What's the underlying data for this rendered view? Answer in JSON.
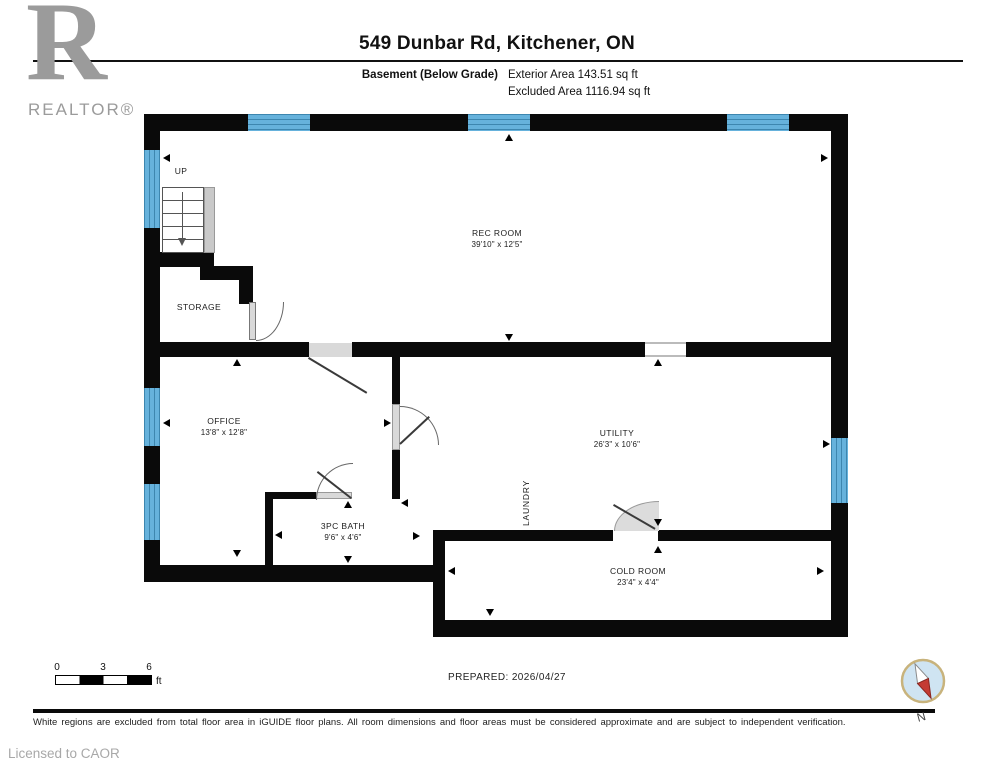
{
  "header": {
    "logo_r": "R",
    "logo_text": "REALTOR®",
    "title": "549 Dunbar Rd, Kitchener, ON",
    "floor_label": "Basement (Below Grade)",
    "area_line1": "Exterior Area 143.51 sq ft",
    "area_line2": "Excluded Area 1116.94 sq ft"
  },
  "rooms": {
    "rec": {
      "name": "REC ROOM",
      "dims": "39'10\" x 12'5\""
    },
    "office": {
      "name": "OFFICE",
      "dims": "13'8\" x 12'8\""
    },
    "utility": {
      "name": "UTILITY",
      "dims": "26'3\" x 10'6\""
    },
    "bath": {
      "name": "3PC BATH",
      "dims": "9'6\" x 4'6\""
    },
    "cold": {
      "name": "COLD ROOM",
      "dims": "23'4\" x 4'4\""
    },
    "storage": {
      "name": "STORAGE"
    },
    "laundry": {
      "name": "LAUNDRY"
    },
    "up": {
      "name": "UP"
    }
  },
  "footer": {
    "scale": {
      "t0": "0",
      "t3": "3",
      "t6": "6",
      "unit": "ft"
    },
    "prepared": "PREPARED: 2026/04/27",
    "disclaimer": "White regions are excluded from total floor area in iGUIDE floor plans. All room dimensions and floor areas must be considered approximate and are subject to independent verification.",
    "licensed": "Licensed to CAOR",
    "compass_n": "N"
  },
  "colors": {
    "wall": "#0a0a0a",
    "window_blue": "#66b2dc",
    "door_gray": "#d9d9d9",
    "compass_fill": "#cfe4f2",
    "compass_ring": "#c8b37c",
    "needle_red": "#c43b33"
  }
}
